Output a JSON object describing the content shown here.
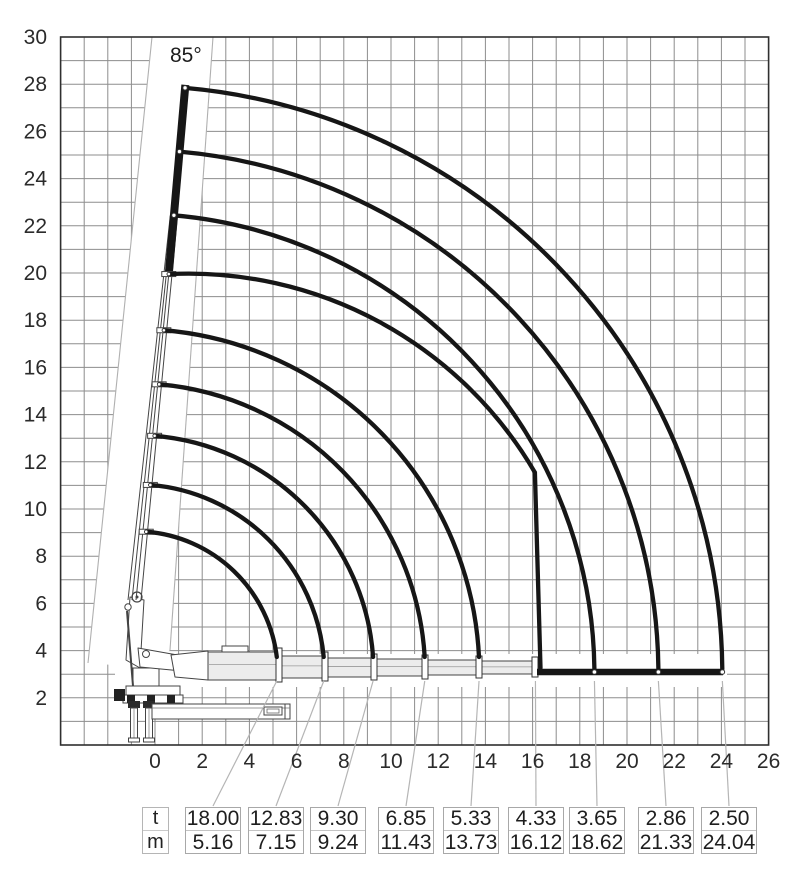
{
  "chart_data": {
    "type": "line",
    "description": "Crane working-range load diagram: lifting capacity arcs vs outreach and height",
    "angle_label": "85°",
    "boom_angle_deg": 85,
    "x_ticks": [
      "0",
      "2",
      "4",
      "6",
      "8",
      "10",
      "12",
      "14",
      "16",
      "18",
      "20",
      "22",
      "24",
      "26"
    ],
    "y_ticks": [
      "30",
      "28",
      "26",
      "24",
      "22",
      "20",
      "18",
      "16",
      "14",
      "12",
      "10",
      "8",
      "6",
      "4",
      "2"
    ],
    "x_range": [
      -4,
      26
    ],
    "y_range": [
      0,
      30
    ],
    "grid": true,
    "grid_step_m": 1,
    "xlabel": "",
    "ylabel": "",
    "series": [
      {
        "name": "capacity_t",
        "values": [
          18.0,
          12.83,
          9.3,
          6.85,
          5.33,
          4.33,
          3.65,
          2.86,
          2.5
        ]
      },
      {
        "name": "outreach_m",
        "values": [
          5.16,
          7.15,
          9.24,
          11.43,
          13.73,
          16.12,
          18.62,
          21.33,
          24.04
        ]
      }
    ],
    "columns": [
      {
        "t": 18.0,
        "m": 5.16,
        "boundary": "arc"
      },
      {
        "t": 12.83,
        "m": 7.15,
        "boundary": "arc"
      },
      {
        "t": 9.3,
        "m": 9.24,
        "boundary": "arc"
      },
      {
        "t": 6.85,
        "m": 11.43,
        "boundary": "arc"
      },
      {
        "t": 5.33,
        "m": 13.73,
        "boundary": "arc"
      },
      {
        "t": 4.33,
        "m": 16.12,
        "boundary": "vertical-drop"
      },
      {
        "t": 3.65,
        "m": 18.62,
        "boundary": "arc"
      },
      {
        "t": 2.86,
        "m": 21.33,
        "boundary": "arc"
      },
      {
        "t": 2.5,
        "m": 24.04,
        "boundary": "arc"
      }
    ]
  },
  "table": {
    "row_labels": [
      "t",
      "m"
    ],
    "columns": [
      {
        "t": "18.00",
        "m": "5.16"
      },
      {
        "t": "12.83",
        "m": "7.15"
      },
      {
        "t": "9.30",
        "m": "9.24"
      },
      {
        "t": "6.85",
        "m": "11.43"
      },
      {
        "t": "5.33",
        "m": "13.73"
      },
      {
        "t": "4.33",
        "m": "16.12"
      },
      {
        "t": "3.65",
        "m": "18.62"
      },
      {
        "t": "2.86",
        "m": "21.33"
      },
      {
        "t": "2.50",
        "m": "24.04"
      }
    ]
  },
  "colors": {
    "arc": "#161616",
    "grid": "#8d8d8d",
    "border": "#2f2f2f",
    "leader": "#b5b5b5",
    "limit_line": "#b0b0b0",
    "text": "#2b2b2b",
    "crane_line": "#444444"
  }
}
